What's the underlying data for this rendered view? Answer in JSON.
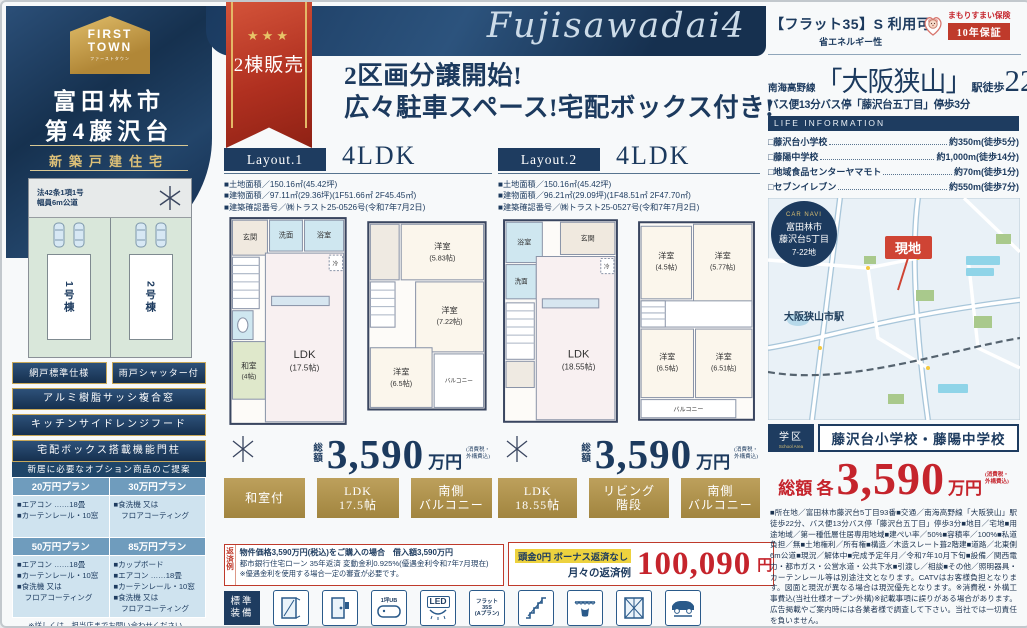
{
  "brand": {
    "logo_line1": "FIRST",
    "logo_line2": "TOWN",
    "logo_sub": "ファーストタウン",
    "city": "富田林市",
    "project": "第4藤沢台",
    "category": "新築戸建住宅"
  },
  "siteplan": {
    "road_note": "法42条1項1号\n幅員6m公道",
    "lot1": "1号棟",
    "lot2": "2号棟"
  },
  "features": [
    "網戸標準仕様",
    "雨戸シャッター付",
    "アルミ樹脂サッシ複合窓",
    "キッチンサイドレンジフード",
    "宅配ボックス搭載機能門柱"
  ],
  "options": {
    "header": "新居に必要なオプション商品のご提案",
    "plans": [
      {
        "title": "20万円プラン",
        "body": "■エアコン ……18畳\n■カーテンレール・10窓"
      },
      {
        "title": "30万円プラン",
        "body": "■食洗機 又は\n　フロアコーティング"
      },
      {
        "title": "50万円プラン",
        "body": "■エアコン ……18畳\n■カーテンレール・10窓\n■食洗機 又は\n　フロアコーティング"
      },
      {
        "title": "85万円プラン",
        "body": "■カップボード\n■エアコン ……18畳\n■カーテンレール・10窓\n■食洗機 又は\n　フロアコーティング"
      }
    ],
    "note": "※詳しくは、担当店までお問い合わせください。"
  },
  "header": {
    "script_title": "Fujisawadai4",
    "ribbon_stars": "★★★",
    "ribbon_label": "2棟販売",
    "headline": "2区画分譲開始!\n広々駐車スペース!宅配ボックス付き!"
  },
  "plans": [
    {
      "layout": "Layout.1",
      "type": "4LDK",
      "spec1": "■土地面積／150.16㎡(45.42坪)",
      "spec2": "■建物面積／97.11㎡(29.36坪)(1F51.66㎡ 2F45.45㎡)",
      "spec3": "■建築確認番号／㈱トラスト25-0526号(令和7年7月2日)",
      "price_label": "総\n額",
      "price": "3,590",
      "price_unit": "万円",
      "price_note": "(消費税・\n外構費込)",
      "badges": [
        [
          "和室付",
          ""
        ],
        [
          "LDK",
          "17.5帖"
        ],
        [
          "南側",
          "バルコニー"
        ]
      ],
      "rooms": {
        "genkan": "玄関",
        "senmen": "洗面",
        "bath": "浴室",
        "rei": "冷",
        "ldk": "LDK",
        "ldk_size": "(17.5帖)",
        "washitsu": "和室",
        "washitsu_size": "(4帖)",
        "r1": "洋室",
        "r1_size": "(5.83帖)",
        "r2": "洋室",
        "r2_size": "(7.22帖)",
        "r3": "洋室",
        "r3_size": "(6.5帖)",
        "balcony": "バルコニー"
      }
    },
    {
      "layout": "Layout.2",
      "type": "4LDK",
      "spec1": "■土地面積／150.16㎡(45.42坪)",
      "spec2": "■建物面積／96.21㎡(29.09坪)(1F48.51㎡ 2F47.70㎡)",
      "spec3": "■建築確認番号／㈱トラスト25-0527号(令和7年7月2日)",
      "price_label": "総\n額",
      "price": "3,590",
      "price_unit": "万円",
      "price_note": "(消費税・\n外構費込)",
      "badges": [
        [
          "LDK",
          "18.55帖"
        ],
        [
          "リビング",
          "階段"
        ],
        [
          "南側",
          "バルコニー"
        ]
      ],
      "rooms": {
        "bath": "浴室",
        "senmen": "洗面",
        "genkan": "玄関",
        "rei": "冷",
        "ldk": "LDK",
        "ldk_size": "(18.55帖)",
        "r1": "洋室",
        "r1_size": "(4.5帖)",
        "r2": "洋室",
        "r2_size": "(5.77帖)",
        "r3": "洋室",
        "r3_size": "(6.5帖)",
        "r4": "洋室",
        "r4_size": "(6.51帖)",
        "balcony": "バルコニー"
      }
    }
  ],
  "payment": {
    "side_label": "返済例",
    "line1": "物件価格3,590万円(税込)をご購入の場合　借入額3,590万円",
    "line2": "都市銀行住宅ローン 35年返済 変動金利0.925%(優遇金利令和7年7月現在)",
    "line3": "※優遇金利を使用する場合一定の審査が必要です。",
    "highlight": "頭金0円 ボーナス返済なし",
    "monthly_label": "月々の返済例",
    "amount": "100,090",
    "unit": "円"
  },
  "equipment": {
    "label": "標準\n装備",
    "ub": "1坪UB",
    "led": "LED",
    "flat35": "フラット\n35S\n(Aプラン)"
  },
  "right": {
    "flat35_title": "【フラット35】S 利用可",
    "flat35_sub": "省エネルギー性",
    "insurance_name": "まもりすまい保険",
    "insurance_warranty": "10年保証",
    "rail_line": "南海高野線",
    "station": "「大阪狭山」",
    "walk_label": "駅徒歩",
    "walk_min": "22",
    "walk_unit": "分",
    "bus_line": "バス便13分バス停「藤沢台五丁目」停歩3分",
    "life_header": "LIFE INFORMATION",
    "life_items": [
      {
        "name": "□藤沢台小学校",
        "value": "約350m(徒歩5分)"
      },
      {
        "name": "□藤陽中学校",
        "value": "約1,000m(徒歩14分)"
      },
      {
        "name": "□地域食品センターヤマモト",
        "value": "約70m(徒歩1分)"
      },
      {
        "name": "□セブンイレブン",
        "value": "約550m(徒歩7分)"
      }
    ],
    "map": {
      "carnavi_label": "CAR NAVI",
      "carnavi_l1": "富田林市",
      "carnavi_l2": "藤沢台5丁目",
      "carnavi_l3": "7-22地",
      "marker": "現地",
      "station_label": "大阪狭山市駅"
    },
    "school_badge": "学区",
    "school_badge_en": "School Area",
    "school_text": "藤沢台小学校・藤陽中学校",
    "total_prefix": "総額 各",
    "total_amount": "3,590",
    "total_unit": "万円",
    "total_note": "(消費税・\n外構費込)",
    "details": "■所在地／富田林市藤沢台5丁目93番■交通／南海高野線「大阪狭山」駅徒歩22分、バス便13分バス停「藤沢台五丁目」停歩3分■地目／宅地■用途地域／第一種低層住居専用地域■建ぺい率／50%■容積率／100%■私道負担／無■土地権利／所有権■構造／木造スレート葺2階建■道路／北東側6m公道■現況／解体中■完成予定年月／令和7年10月下旬■設備／関西電力・都市ガス・公営水道・公共下水■引渡し／相談■その他／照明器具・カーテンレール等は別途注文となります。CATVはお客様負担となります。図面と現況が異なる場合は現況優先となります。※消費税・外構工事費込(当社仕様オープン外構)※記載事項に誤りがある場合があります。広告掲載やご案内時には各業者様で調査して下さい。当社では一切責任を負いません。"
  },
  "colors": {
    "navy": "#1e3c60",
    "gold": "#b2945a",
    "red": "#bf3a2b",
    "price_red": "#c5242c"
  }
}
